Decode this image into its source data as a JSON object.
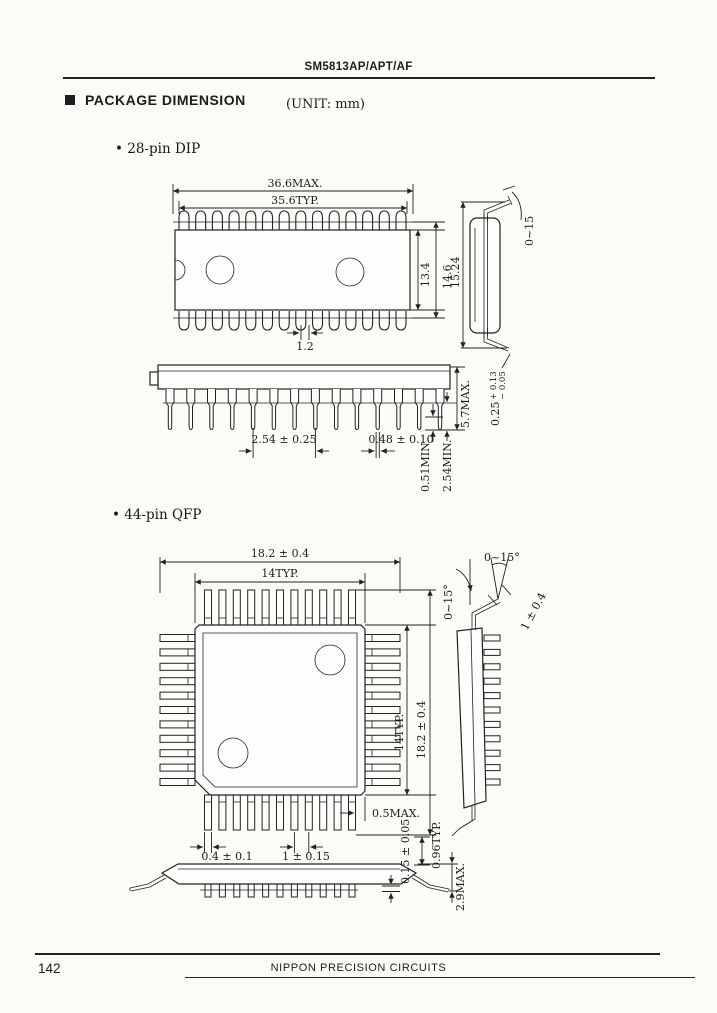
{
  "header": {
    "title": "SM5813AP/APT/AF"
  },
  "section": {
    "title": "PACKAGE DIMENSION",
    "unit": "(UNIT: mm)"
  },
  "dip": {
    "label": "• 28-pin DIP",
    "dims": {
      "overall_max": "36.6MAX.",
      "overall_typ": "35.6TYP.",
      "body_width": "13.4",
      "shoulder_width": "14.6",
      "row_spacing": "15.24",
      "lead_angle": "0~15",
      "offset": "1.2",
      "pitch": "2.54 ± 0.25",
      "lead_width": "0.48 ± 0.10",
      "height_max": "5.7MAX.",
      "standoff_min": "0.51MIN.",
      "lead_len_min": "2.54MIN.",
      "thickness_base": "0.25",
      "thickness_plus": "+ 0.13",
      "thickness_minus": "− 0.05"
    }
  },
  "qfp": {
    "label": "• 44-pin QFP",
    "dims": {
      "overall_h": "18.2 ± 0.4",
      "body_h": "14TYP.",
      "body_v": "14TYP.",
      "overall_v": "18.2 ± 0.4",
      "lead_angle_side": "0~15°",
      "lead_angle_tip": "0~15°",
      "foot_len": "1 ± 0.4",
      "tip_max": "0.5MAX.",
      "lead_width": "0.4 ± 0.1",
      "pitch": "1 ± 0.15",
      "thickness": "0.15 ± 0.05",
      "foot_typ": "0.96TYP.",
      "height_max": "2.9MAX."
    }
  },
  "footer": {
    "page_number": "142",
    "company": "NIPPON PRECISION CIRCUITS"
  }
}
